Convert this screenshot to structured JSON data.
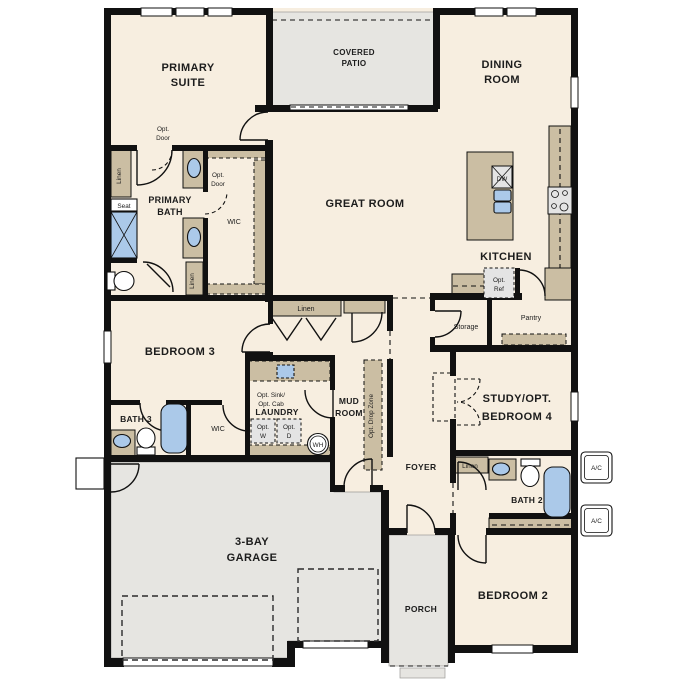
{
  "colors": {
    "floor": "#f7eee0",
    "outdoor": "#e6e5e1",
    "wall": "#111111",
    "cabinet": "#cbbea3",
    "fixture_blue": "#abc9e9",
    "appliance": "#e4e4e4",
    "text": "#1c1c1c"
  },
  "labels": {
    "primary_suite": [
      "PRIMARY",
      "SUITE"
    ],
    "covered_patio": [
      "COVERED",
      "PATIO"
    ],
    "dining_room": [
      "DINING",
      "ROOM"
    ],
    "great_room": "GREAT ROOM",
    "kitchen": "KITCHEN",
    "dw": "DW",
    "opt_ref": [
      "Opt.",
      "Ref"
    ],
    "pantry": "Pantry",
    "storage": "Storage",
    "primary_bath": [
      "PRIMARY",
      "BATH"
    ],
    "wic": "WIC",
    "linen": "Linen",
    "seat": "Seat",
    "opt_door": [
      "Opt.",
      "Door"
    ],
    "bedroom3": "BEDROOM 3",
    "bath3": "BATH 3",
    "laundry": "LAUNDRY",
    "opt_sink_cab": [
      "Opt. Sink/",
      "Opt. Cab"
    ],
    "opt_w": [
      "Opt.",
      "W"
    ],
    "opt_d": [
      "Opt.",
      "D"
    ],
    "wh": "WH",
    "mud_room": [
      "MUD",
      "ROOM"
    ],
    "opt_drop_zone": "Opt. Drop Zone",
    "foyer": "FOYER",
    "study_bedroom4": [
      "STUDY/OPT.",
      "BEDROOM 4"
    ],
    "bath2": "BATH 2",
    "bedroom2": "BEDROOM 2",
    "garage": [
      "3-BAY",
      "GARAGE"
    ],
    "porch": "PORCH",
    "ac": "A/C"
  }
}
